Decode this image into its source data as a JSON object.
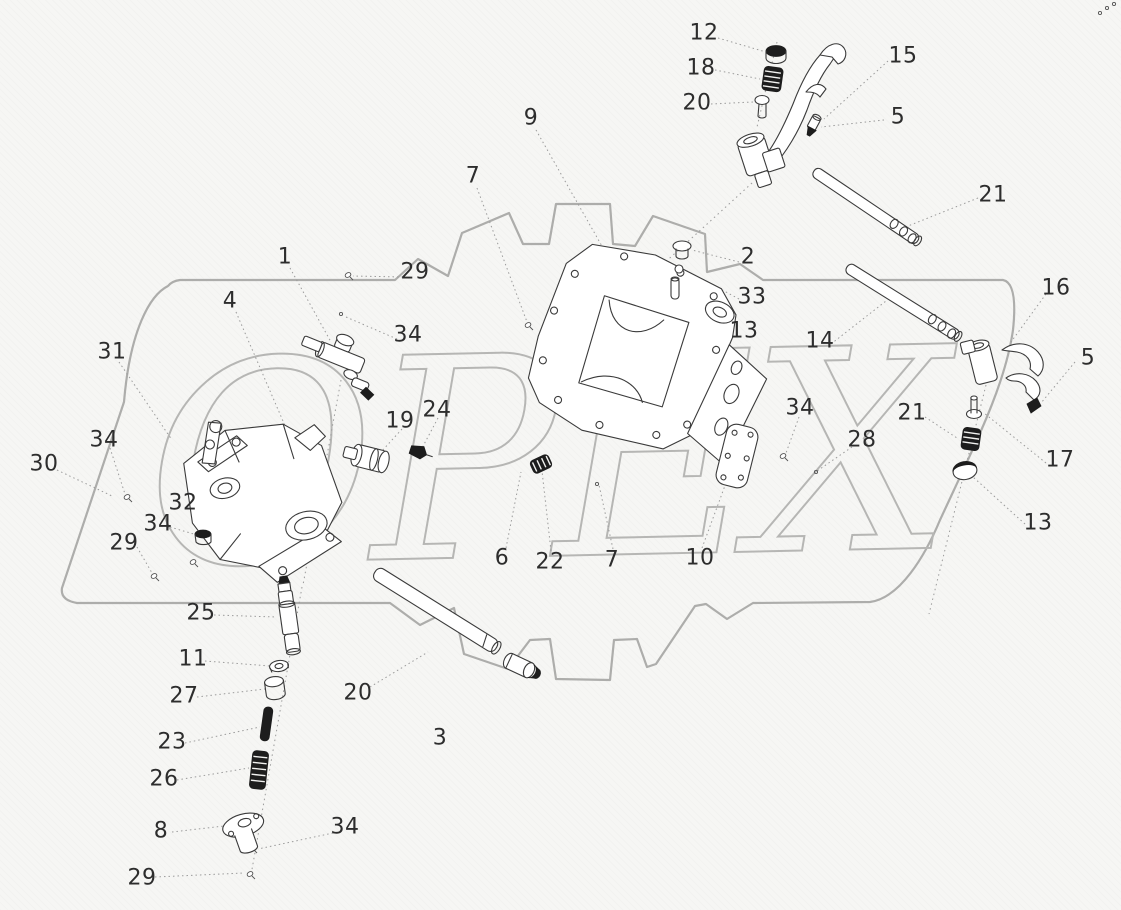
{
  "figure": {
    "kind": "exploded-parts-diagram",
    "watermark_text": "OPEX",
    "watermark_color": "#b6b6b4",
    "outline_color": "#adadab",
    "leader_color": "#9b9b9b",
    "label_color": "#2d2d2d"
  },
  "callouts": [
    {
      "label": "12",
      "x": 704,
      "y": 33,
      "leader": [
        [
          718,
          38
        ],
        [
          766,
          52
        ]
      ]
    },
    {
      "label": "18",
      "x": 701,
      "y": 68,
      "leader": [
        [
          715,
          70
        ],
        [
          760,
          79
        ]
      ]
    },
    {
      "label": "20",
      "x": 697,
      "y": 103,
      "leader": [
        [
          711,
          104
        ],
        [
          753,
          102
        ]
      ]
    },
    {
      "label": "15",
      "x": 903,
      "y": 56,
      "leader": [
        [
          888,
          61
        ],
        [
          824,
          119
        ]
      ]
    },
    {
      "label": "5",
      "x": 898,
      "y": 117,
      "leader": [
        [
          884,
          120
        ],
        [
          821,
          127
        ]
      ]
    },
    {
      "label": "21",
      "x": 993,
      "y": 195,
      "leader": [
        [
          978,
          198
        ],
        [
          903,
          228
        ]
      ]
    },
    {
      "label": "9",
      "x": 531,
      "y": 118,
      "leader": [
        [
          536,
          130
        ],
        [
          607,
          255
        ]
      ]
    },
    {
      "label": "7",
      "x": 473,
      "y": 176,
      "leader": [
        [
          477,
          188
        ],
        [
          527,
          322
        ]
      ]
    },
    {
      "label": "1",
      "x": 285,
      "y": 257,
      "leader": [
        [
          290,
          268
        ],
        [
          331,
          342
        ]
      ]
    },
    {
      "label": "29",
      "x": 415,
      "y": 272,
      "leader": [
        [
          403,
          277
        ],
        [
          353,
          276
        ]
      ]
    },
    {
      "label": "4",
      "x": 230,
      "y": 301,
      "leader": [
        [
          236,
          312
        ],
        [
          286,
          428
        ]
      ]
    },
    {
      "label": "34",
      "x": 408,
      "y": 335,
      "leader": [
        [
          397,
          339
        ],
        [
          346,
          317
        ]
      ]
    },
    {
      "label": "31",
      "x": 112,
      "y": 352,
      "leader": [
        [
          119,
          362
        ],
        [
          172,
          440
        ]
      ]
    },
    {
      "label": "34",
      "x": 104,
      "y": 440,
      "leader": [
        [
          110,
          448
        ],
        [
          125,
          494
        ]
      ]
    },
    {
      "label": "30",
      "x": 44,
      "y": 464,
      "leader": [
        [
          57,
          470
        ],
        [
          112,
          496
        ]
      ]
    },
    {
      "label": "19",
      "x": 400,
      "y": 421,
      "leader": [
        [
          402,
          429
        ],
        [
          381,
          452
        ]
      ]
    },
    {
      "label": "24",
      "x": 437,
      "y": 410,
      "leader": [
        [
          438,
          418
        ],
        [
          421,
          450
        ]
      ]
    },
    {
      "label": "32",
      "x": 183,
      "y": 503,
      "leader": [
        [
          196,
          507
        ],
        [
          231,
          516
        ]
      ]
    },
    {
      "label": "34",
      "x": 158,
      "y": 524,
      "leader": [
        [
          170,
          527
        ],
        [
          197,
          535
        ]
      ]
    },
    {
      "label": "29",
      "x": 124,
      "y": 543,
      "leader": [
        [
          137,
          547
        ],
        [
          152,
          573
        ]
      ]
    },
    {
      "label": "2",
      "x": 748,
      "y": 257,
      "leader": [
        [
          739,
          262
        ],
        [
          692,
          250
        ]
      ]
    },
    {
      "label": "33",
      "x": 752,
      "y": 297,
      "leader": [
        [
          739,
          299
        ],
        [
          687,
          271
        ]
      ]
    },
    {
      "label": "13",
      "x": 744,
      "y": 331,
      "leader": [
        [
          732,
          333
        ],
        [
          681,
          291
        ]
      ]
    },
    {
      "label": "14",
      "x": 820,
      "y": 341,
      "leader": [
        [
          831,
          344
        ],
        [
          886,
          301
        ]
      ]
    },
    {
      "label": "16",
      "x": 1056,
      "y": 288,
      "leader": [
        [
          1046,
          294
        ],
        [
          1011,
          342
        ]
      ]
    },
    {
      "label": "5",
      "x": 1088,
      "y": 358,
      "leader": [
        [
          1075,
          362
        ],
        [
          1041,
          403
        ]
      ]
    },
    {
      "label": "17",
      "x": 1060,
      "y": 460,
      "leader": [
        [
          1046,
          463
        ],
        [
          984,
          413
        ]
      ]
    },
    {
      "label": "21",
      "x": 912,
      "y": 413,
      "leader": [
        [
          925,
          417
        ],
        [
          957,
          438
        ]
      ]
    },
    {
      "label": "28",
      "x": 862,
      "y": 440,
      "leader": [
        [
          852,
          447
        ],
        [
          817,
          471
        ]
      ]
    },
    {
      "label": "34",
      "x": 800,
      "y": 408,
      "leader": [
        [
          799,
          417
        ],
        [
          786,
          453
        ]
      ]
    },
    {
      "label": "13",
      "x": 1038,
      "y": 523,
      "leader": [
        [
          1025,
          524
        ],
        [
          973,
          477
        ]
      ]
    },
    {
      "label": "6",
      "x": 502,
      "y": 558,
      "leader": [
        [
          506,
          548
        ],
        [
          521,
          472
        ]
      ]
    },
    {
      "label": "22",
      "x": 550,
      "y": 562,
      "leader": [
        [
          551,
          551
        ],
        [
          542,
          471
        ]
      ]
    },
    {
      "label": "7",
      "x": 612,
      "y": 560,
      "leader": [
        [
          613,
          549
        ],
        [
          599,
          485
        ]
      ]
    },
    {
      "label": "10",
      "x": 700,
      "y": 558,
      "leader": [
        [
          702,
          548
        ],
        [
          730,
          472
        ]
      ]
    },
    {
      "label": "20",
      "x": 358,
      "y": 693,
      "leader": [
        [
          370,
          687
        ],
        [
          428,
          652
        ]
      ]
    },
    {
      "label": "3",
      "x": 440,
      "y": 738,
      "leader": []
    },
    {
      "label": "25",
      "x": 201,
      "y": 613,
      "leader": [
        [
          214,
          615
        ],
        [
          276,
          617
        ]
      ]
    },
    {
      "label": "11",
      "x": 193,
      "y": 659,
      "leader": [
        [
          205,
          661
        ],
        [
          270,
          666
        ]
      ]
    },
    {
      "label": "27",
      "x": 184,
      "y": 696,
      "leader": [
        [
          197,
          697
        ],
        [
          265,
          689
        ]
      ]
    },
    {
      "label": "23",
      "x": 172,
      "y": 742,
      "leader": [
        [
          185,
          743
        ],
        [
          260,
          727
        ]
      ]
    },
    {
      "label": "26",
      "x": 164,
      "y": 779,
      "leader": [
        [
          177,
          780
        ],
        [
          249,
          768
        ]
      ]
    },
    {
      "label": "8",
      "x": 161,
      "y": 831,
      "leader": [
        [
          172,
          832
        ],
        [
          224,
          826
        ]
      ]
    },
    {
      "label": "34",
      "x": 345,
      "y": 827,
      "leader": [
        [
          333,
          833
        ],
        [
          258,
          849
        ]
      ]
    },
    {
      "label": "29",
      "x": 142,
      "y": 878,
      "leader": [
        [
          155,
          877
        ],
        [
          244,
          873
        ]
      ]
    }
  ],
  "axis_lines": [
    [
      [
        341,
        380
      ],
      [
        303,
        585
      ]
    ],
    [
      [
        302,
        587
      ],
      [
        251,
        875
      ]
    ],
    [
      [
        986,
        385
      ],
      [
        929,
        614
      ]
    ],
    [
      [
        777,
        42
      ],
      [
        757,
        127
      ]
    ],
    [
      [
        752,
        183
      ],
      [
        591,
        330
      ]
    ]
  ],
  "tiny_marks": [
    {
      "x": 348,
      "y": 275,
      "type": "screw"
    },
    {
      "x": 341,
      "y": 314,
      "type": "dot"
    },
    {
      "x": 528,
      "y": 325,
      "type": "screw"
    },
    {
      "x": 127,
      "y": 497,
      "type": "screw"
    },
    {
      "x": 193,
      "y": 562,
      "type": "screw"
    },
    {
      "x": 154,
      "y": 576,
      "type": "screw"
    },
    {
      "x": 783,
      "y": 456,
      "type": "screw"
    },
    {
      "x": 816,
      "y": 472,
      "type": "dot"
    },
    {
      "x": 597,
      "y": 484,
      "type": "dot"
    },
    {
      "x": 252,
      "y": 848,
      "type": "screw"
    },
    {
      "x": 250,
      "y": 874,
      "type": "screw"
    },
    {
      "x": 1100,
      "y": 13,
      "type": "dot"
    },
    {
      "x": 1107,
      "y": 8,
      "type": "dot"
    },
    {
      "x": 1114,
      "y": 4,
      "type": "dot"
    }
  ]
}
